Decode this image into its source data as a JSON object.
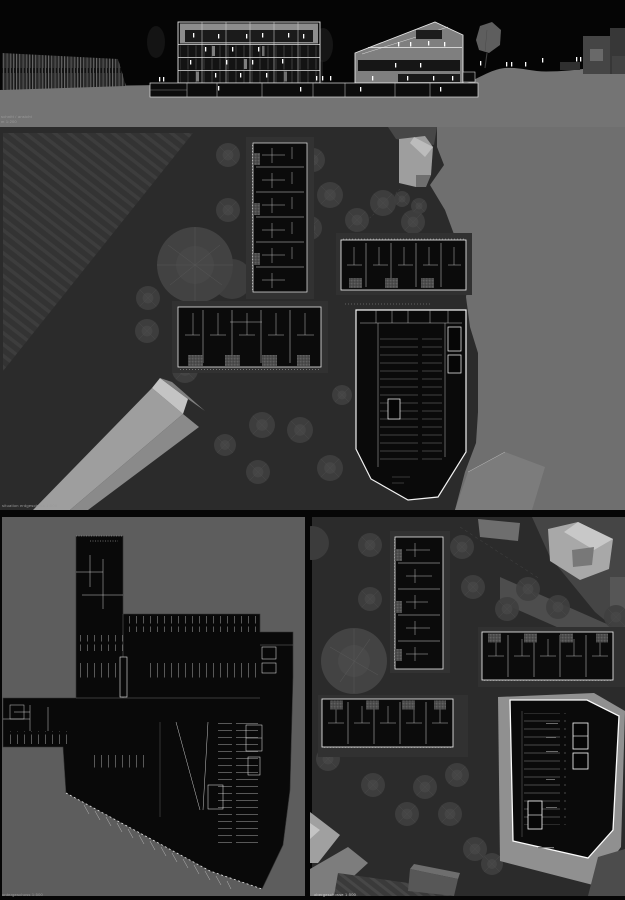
{
  "header": {
    "title": "ideen- und realisierungswettbewerb \"entwicklung ortsmitte oberhofen\"",
    "sheet_number": "240821"
  },
  "captions": {
    "section_line1": "schnitt / ansicht",
    "section_line2": "m 1:200",
    "site_plan": "situation erdgeschoss 1:500",
    "lower_left": "untergeschoss 1:500",
    "lower_right": "obergeschosse 1:500"
  },
  "palette": {
    "page_background": "#060606",
    "plan_background_dark": "#2b2b2b",
    "plan_background_light": "#5d5d5d",
    "terrain_gray": "#747474",
    "open_area_gray": "#6f6f6f",
    "new_building_black": "#0b0b0b",
    "drawing_line_white": "#ececec",
    "existing_building_light": "#a8a8a8"
  },
  "elevation": {
    "people": [
      [
        159,
        77
      ],
      [
        163,
        77
      ],
      [
        316,
        76
      ],
      [
        322,
        76
      ],
      [
        330,
        76
      ],
      [
        480,
        61
      ],
      [
        506,
        62
      ],
      [
        511,
        62
      ],
      [
        525,
        62
      ],
      [
        542,
        58
      ],
      [
        576,
        57
      ],
      [
        580,
        57
      ],
      [
        193,
        33
      ],
      [
        218,
        34
      ],
      [
        246,
        34
      ],
      [
        262,
        33
      ],
      [
        288,
        33
      ],
      [
        303,
        34
      ],
      [
        205,
        47
      ],
      [
        232,
        47
      ],
      [
        258,
        47
      ],
      [
        190,
        60
      ],
      [
        226,
        60
      ],
      [
        252,
        60
      ],
      [
        282,
        59
      ],
      [
        215,
        73
      ],
      [
        240,
        73
      ],
      [
        266,
        73
      ],
      [
        398,
        42
      ],
      [
        410,
        42
      ],
      [
        428,
        41
      ],
      [
        444,
        42
      ],
      [
        395,
        63
      ],
      [
        420,
        63
      ],
      [
        372,
        76
      ],
      [
        407,
        76
      ],
      [
        433,
        76
      ],
      [
        452,
        76
      ],
      [
        218,
        86
      ],
      [
        300,
        87
      ],
      [
        360,
        87
      ],
      [
        440,
        87
      ]
    ]
  },
  "site_plan": {
    "trees": [
      [
        228,
        28,
        12
      ],
      [
        313,
        33,
        12
      ],
      [
        330,
        68,
        13
      ],
      [
        383,
        76,
        13
      ],
      [
        357,
        93,
        12
      ],
      [
        413,
        95,
        12
      ],
      [
        310,
        101,
        12
      ],
      [
        228,
        83,
        12
      ],
      [
        148,
        171,
        12
      ],
      [
        147,
        204,
        12
      ],
      [
        185,
        243,
        13
      ],
      [
        342,
        268,
        10
      ],
      [
        262,
        298,
        13
      ],
      [
        300,
        303,
        13
      ],
      [
        330,
        341,
        13
      ],
      [
        258,
        345,
        12
      ],
      [
        225,
        318,
        11
      ],
      [
        402,
        72,
        8
      ],
      [
        419,
        79,
        8
      ]
    ]
  },
  "lower_right": {
    "trees": [
      [
        60,
        28,
        12
      ],
      [
        152,
        30,
        12
      ],
      [
        163,
        70,
        12
      ],
      [
        218,
        72,
        12
      ],
      [
        197,
        92,
        12
      ],
      [
        248,
        90,
        12
      ],
      [
        306,
        100,
        12
      ],
      [
        60,
        82,
        12
      ],
      [
        18,
        242,
        12
      ],
      [
        63,
        268,
        12
      ],
      [
        115,
        270,
        12
      ],
      [
        147,
        258,
        12
      ],
      [
        97,
        297,
        12
      ],
      [
        140,
        297,
        12
      ],
      [
        165,
        332,
        12
      ],
      [
        117,
        363,
        11
      ],
      [
        182,
        347,
        11
      ]
    ]
  }
}
